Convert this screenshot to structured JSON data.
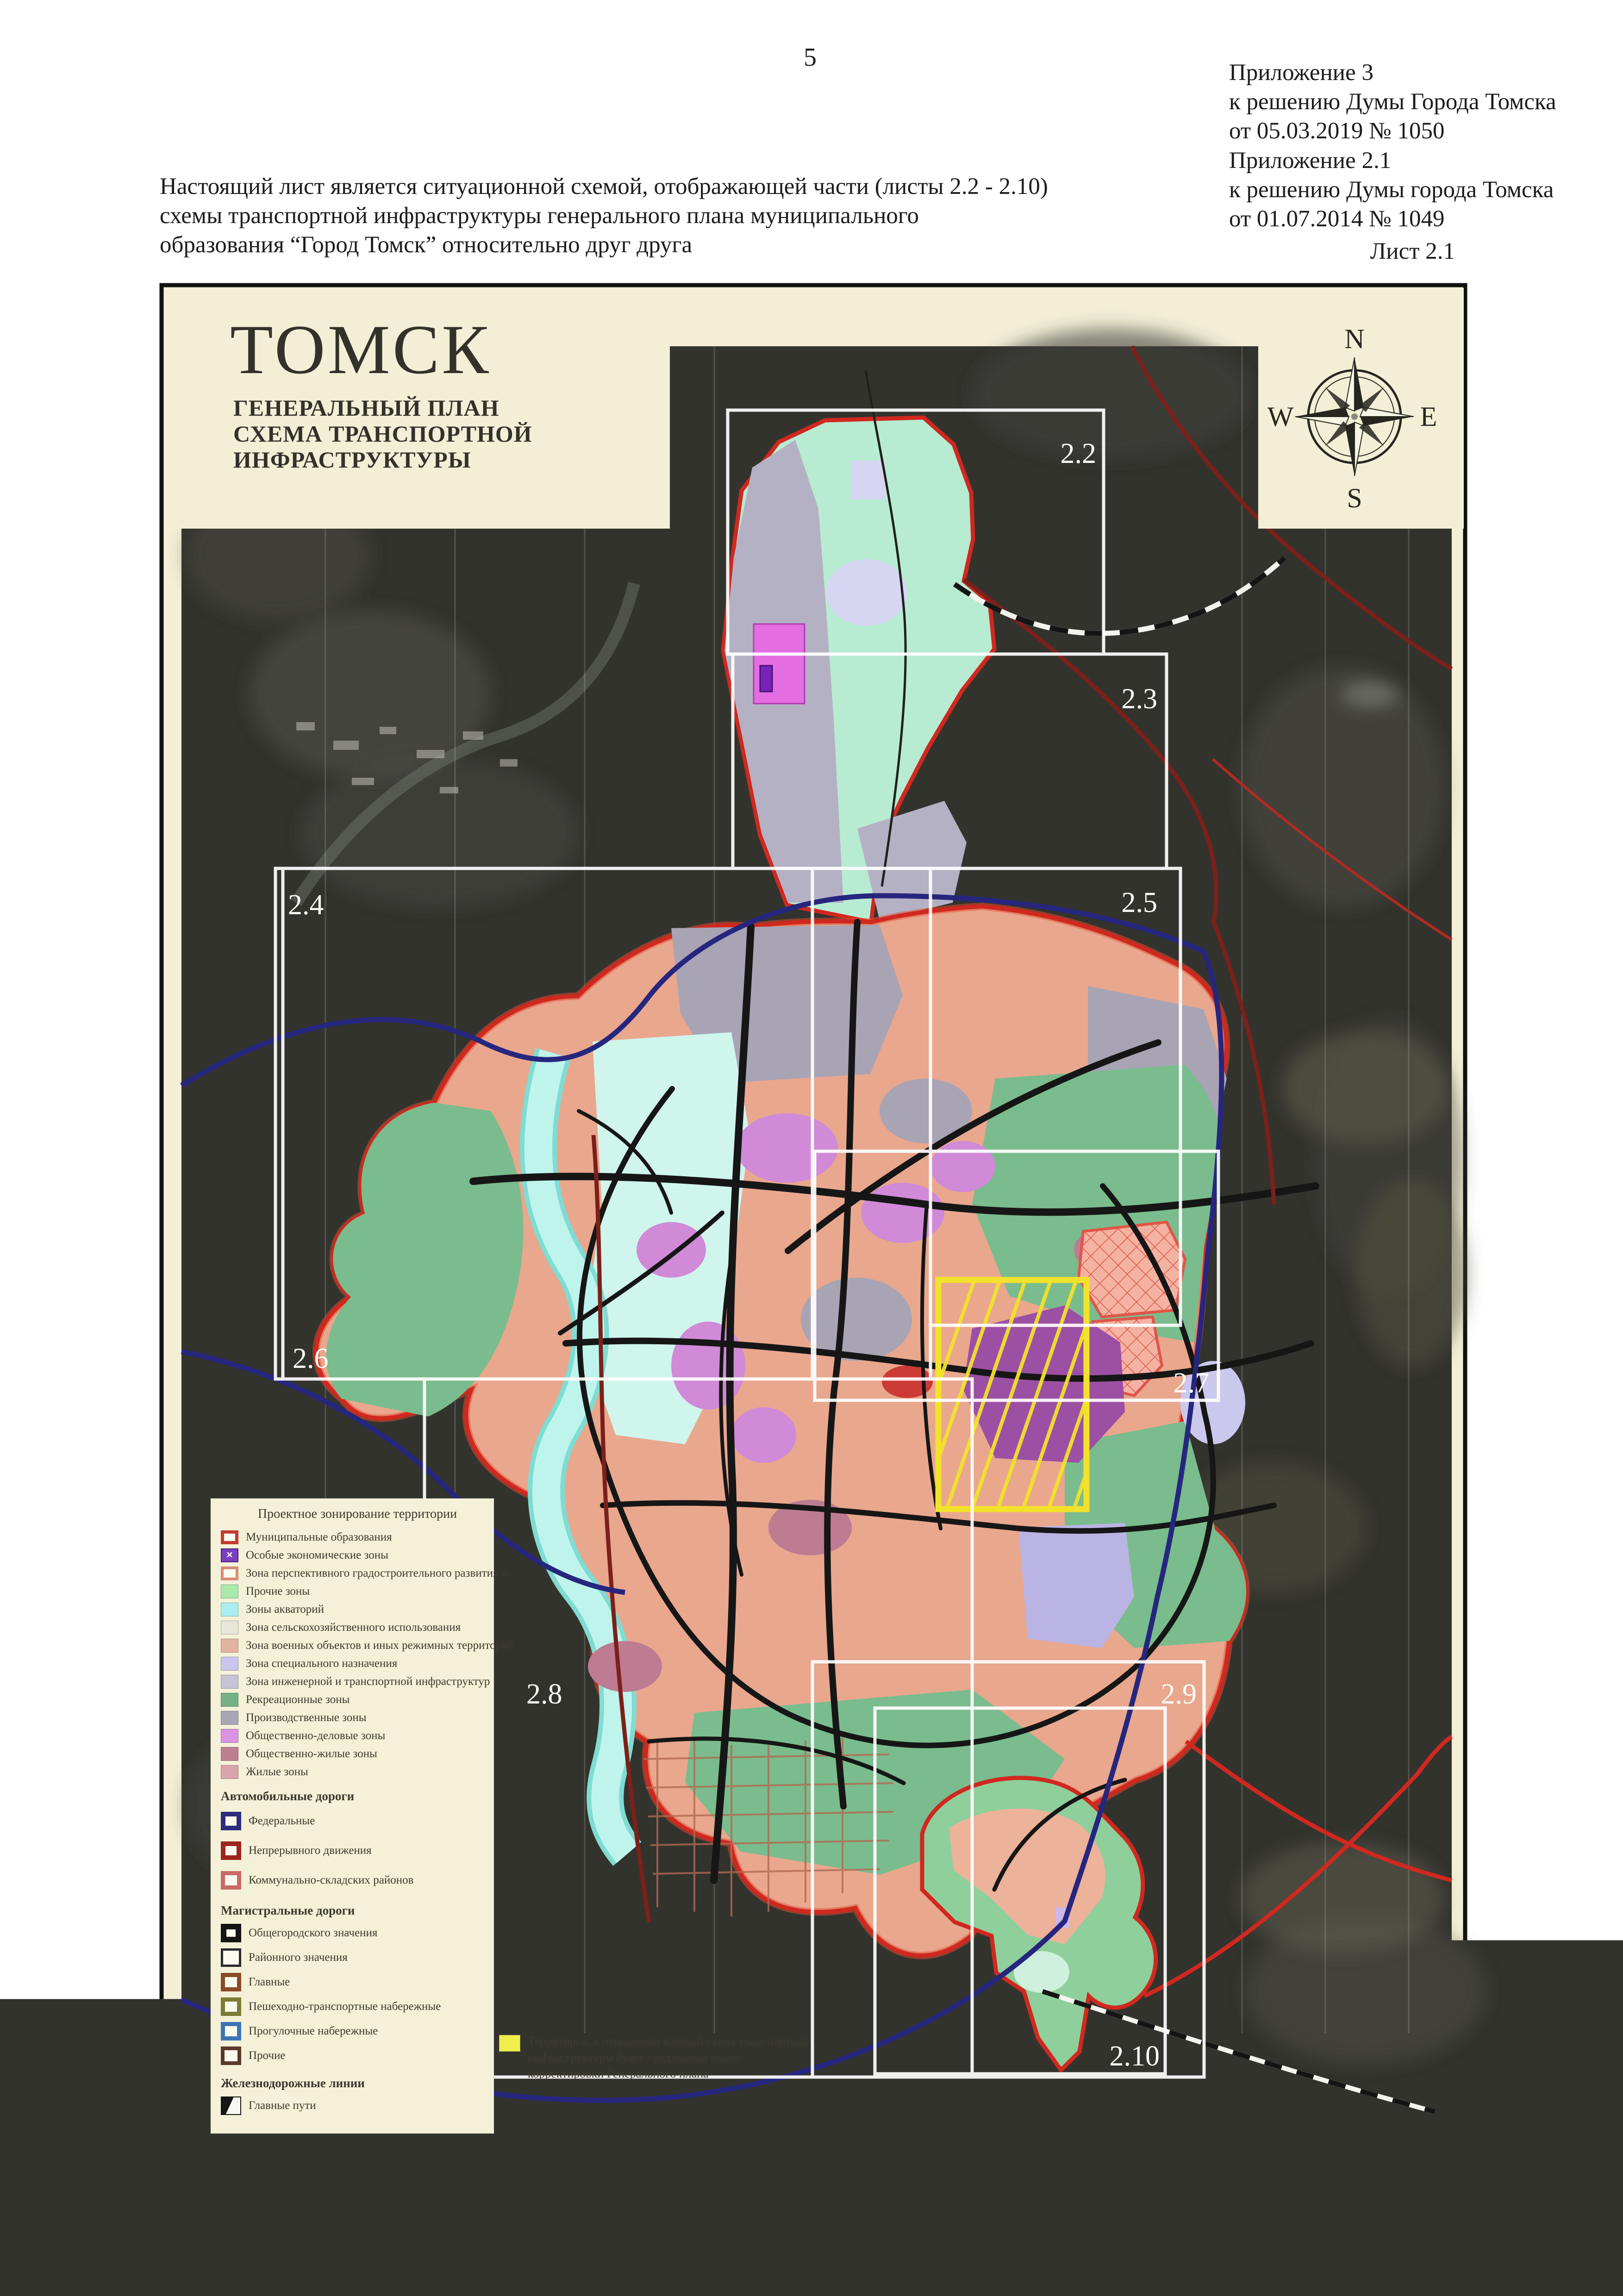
{
  "page": {
    "number": "5"
  },
  "header": {
    "appendix1": {
      "l1": "Приложение 3",
      "l2": "к решению Думы Города Томска",
      "l3": "от 05.03.2019 № 1050"
    },
    "appendix2": {
      "l1": "Приложение 2.1",
      "l2": "к решению Думы города Томска",
      "l3": "от 01.07.2014 № 1049"
    },
    "sheet_label": "Лист 2.1"
  },
  "intro": {
    "line1": "Настоящий лист является ситуационной схемой, отображающей части (листы 2.2 - 2.10)",
    "line2": "схемы транспортной инфраструктуры генерального плана муниципального",
    "line3": "образования “Город Томск” относительно друг друга"
  },
  "map": {
    "title": "ТОМСК",
    "subtitle1": "ГЕНЕРАЛЬНЫЙ ПЛАН",
    "subtitle2": "СХЕМА ТРАНСПОРТНОЙ",
    "subtitle3": "ИНФРАСТРУКТУРЫ",
    "compass": {
      "n": "N",
      "e": "E",
      "s": "S",
      "w": "W"
    },
    "grid_labels": {
      "s22": "2.2",
      "s23": "2.3",
      "s24": "2.4",
      "s25": "2.5",
      "s26": "2.6",
      "s27": "2.7",
      "s28": "2.8",
      "s29": "2.9",
      "s210": "2.10"
    }
  },
  "legend": {
    "title": "Проектное зонирование территории",
    "zones": [
      {
        "label": "Муниципальные образования",
        "type": "outline",
        "color": "#c23b2e",
        "bw": 7
      },
      {
        "label": "Особые экономические зоны",
        "type": "x",
        "color": "#7b3fbe"
      },
      {
        "label": "Зона перспективного градостроительного развития и",
        "type": "outline",
        "color": "#d98b77",
        "bw": 6
      },
      {
        "label": "Прочие зоны",
        "type": "fill",
        "color": "#a9e9ae"
      },
      {
        "label": "Зоны акваторий",
        "type": "fill",
        "color": "#a9eef0"
      },
      {
        "label": "Зона сельскохозяйственного использования",
        "type": "fill",
        "color": "#e6e6da"
      },
      {
        "label": "Зона военных объектов и иных режимных территорий",
        "type": "fill",
        "color": "#e3b3a1"
      },
      {
        "label": "Зона специального назначения",
        "type": "fill",
        "color": "#c9c5ec"
      },
      {
        "label": "Зона инженерной и транспортной инфраструктур",
        "type": "fill",
        "color": "#c6c3d6"
      },
      {
        "label": "Рекреационные зоны",
        "type": "fill",
        "color": "#74b184"
      },
      {
        "label": "Производственные зоны",
        "type": "fill",
        "color": "#a9a7b6"
      },
      {
        "label": "Общественно-деловые зоны",
        "type": "fill",
        "color": "#d993e2"
      },
      {
        "label": "Общественно-жилые зоны",
        "type": "fill",
        "color": "#bf7e92"
      },
      {
        "label": "Жилые зоны",
        "type": "fill",
        "color": "#dba3ab"
      }
    ],
    "roads_header": "Автомобильные дороги",
    "roads": [
      {
        "label": "Федеральные",
        "type": "outline",
        "color": "#2d2d7e",
        "bw": 10
      },
      {
        "label": "Непрерывного движения",
        "type": "outline",
        "color": "#9e2420",
        "bw": 10
      },
      {
        "label": "Коммунально-складских районов",
        "type": "outline",
        "color": "#c96a66",
        "bw": 9
      }
    ],
    "mag_header": "Магистральные дороги",
    "mag": [
      {
        "label": "Общегородского значения",
        "type": "outline",
        "color": "#141414",
        "bw": 12
      },
      {
        "label": "Районного значения",
        "type": "outline",
        "color": "#2a2a2a",
        "bw": 5
      },
      {
        "label": "Главные",
        "type": "outline",
        "color": "#8a4a28",
        "bw": 9
      },
      {
        "label": "Пешеходно-транспортные набережные",
        "type": "outline",
        "color": "#7c7c34",
        "bw": 9
      },
      {
        "label": "Прогулочные набережные",
        "type": "outline",
        "color": "#3f74b4",
        "bw": 9
      },
      {
        "label": "Прочие",
        "type": "outline",
        "color": "#5c372a",
        "bw": 8
      }
    ],
    "rail_header": "Железнодорожные линии",
    "rail": [
      {
        "label": "Главные пути",
        "type": "split"
      }
    ],
    "note": {
      "label": "Территория, в отношении которой схема транспортной инфраструктуры будет предложена после корректировки Генерального плана",
      "type": "fill",
      "color": "#f0ee4a"
    }
  },
  "signatures": {
    "left_title": "Председатель  Думы Города Томска",
    "left_name": "С.Ю. Панов",
    "right_title": "Мэр Города Томска",
    "right_name": "И.Г. Кляйн"
  },
  "colors": {
    "boundary_red": "#d0281f",
    "federal_road_blue": "#26267e",
    "highlight_yellow": "#f2e22c",
    "panel_cream": "#f2efd6",
    "satellite_dark": "#33332e",
    "grid_white": "#ffffff"
  }
}
